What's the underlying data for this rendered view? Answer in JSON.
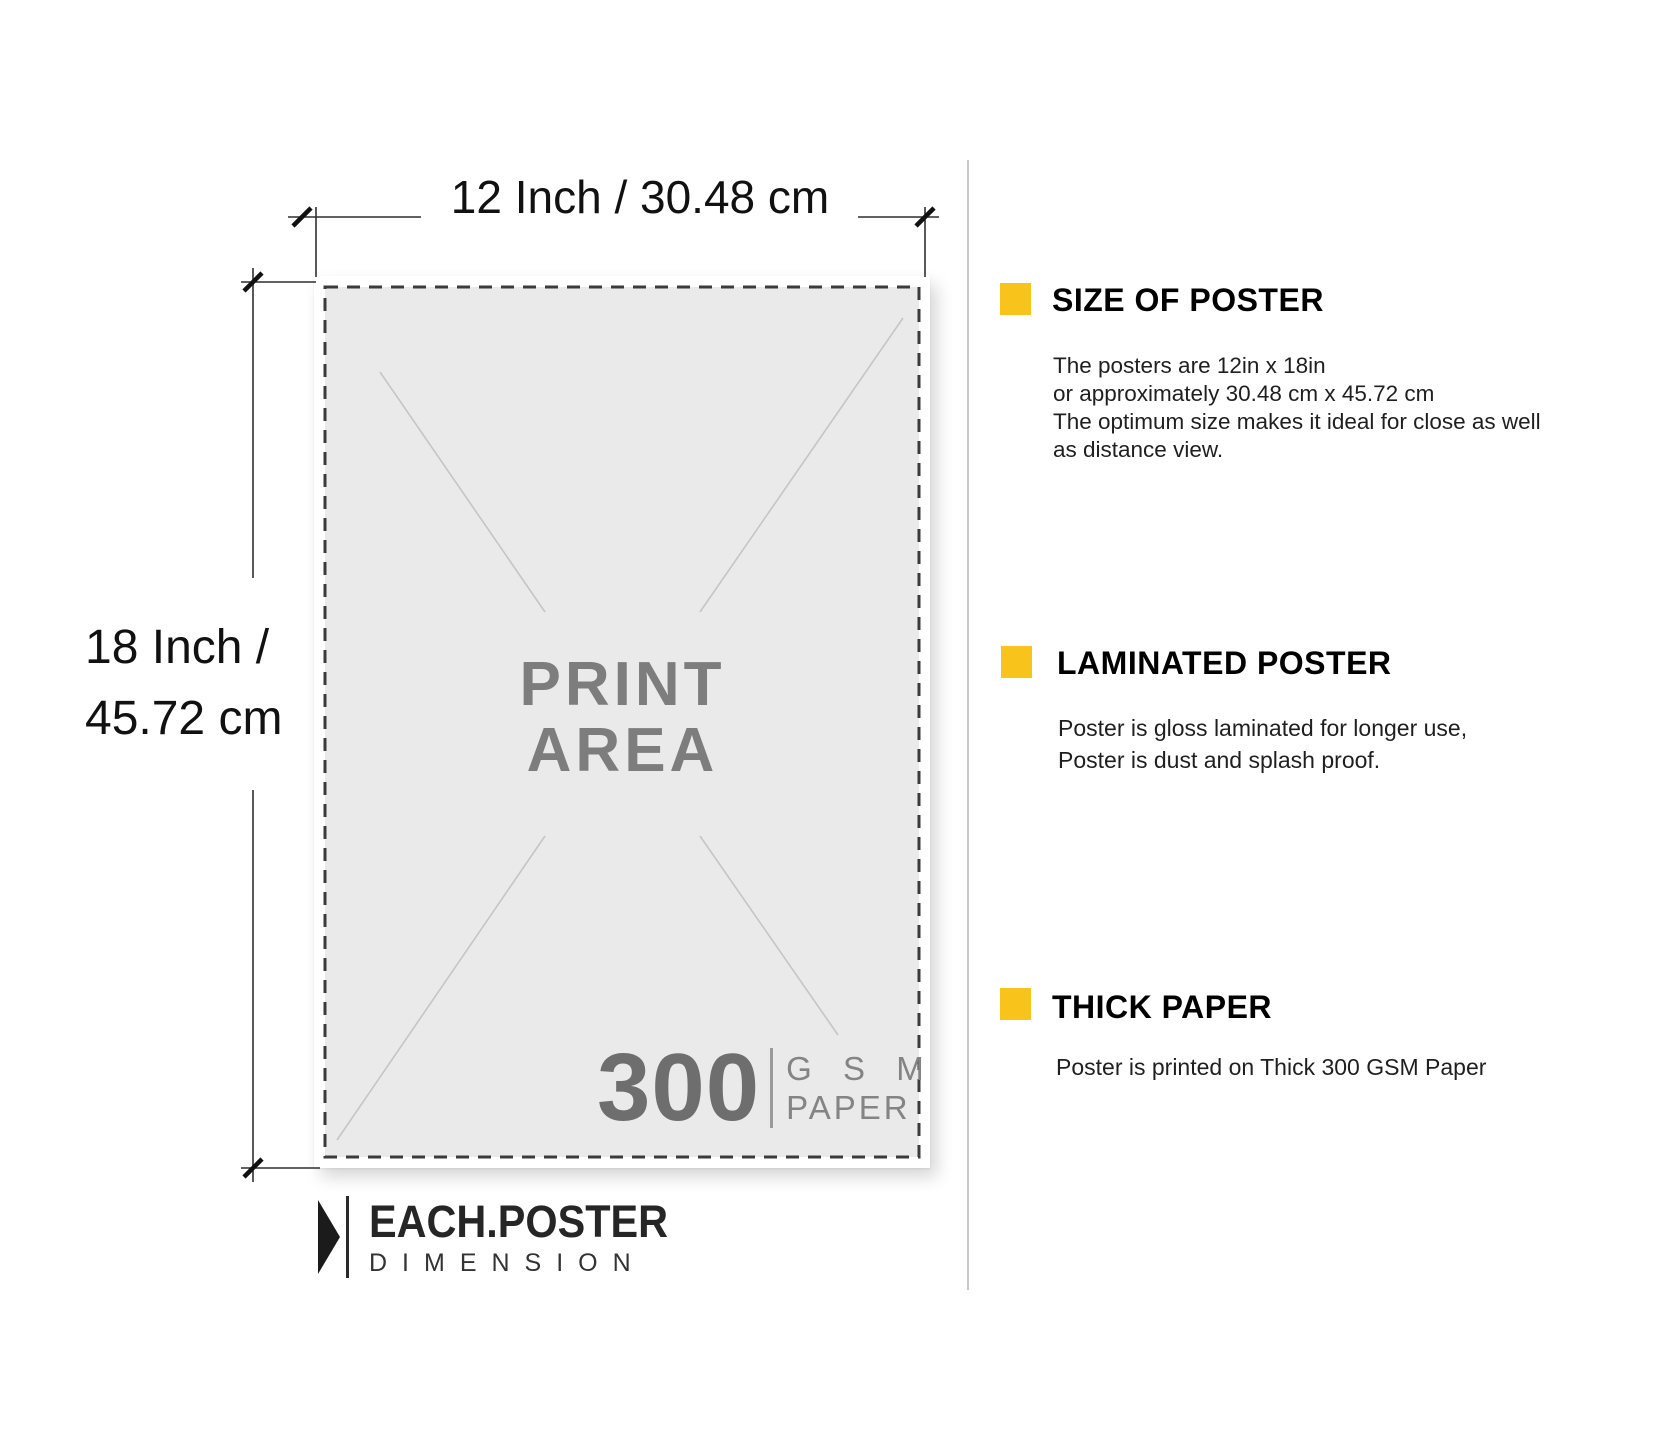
{
  "diagram": {
    "top_dimension_label": "12 Inch / 30.48 cm",
    "left_dimension_label_line1": "18 Inch /",
    "left_dimension_label_line2": "45.72 cm",
    "print_area_line1": "PRINT",
    "print_area_line2": "AREA",
    "paper_weight_value": "300",
    "paper_weight_unit_line1": "G S M",
    "paper_weight_unit_line2": "PAPER",
    "logo_title": "EACH.POSTER",
    "logo_subtitle": "DIMENSION"
  },
  "info_panel": {
    "accent_color": "#f8c31b",
    "sections": [
      {
        "heading": "SIZE OF POSTER",
        "lines": [
          "The posters are 12in x 18in",
          "or approximately 30.48 cm x 45.72 cm",
          "The optimum size makes it ideal for close as well",
          "as distance view."
        ]
      },
      {
        "heading": "LAMINATED POSTER",
        "lines": [
          "Poster is gloss laminated for longer use,",
          "Poster is dust and splash proof."
        ]
      },
      {
        "heading": "THICK PAPER",
        "lines": [
          "Poster is printed on Thick 300 GSM Paper"
        ]
      }
    ]
  }
}
